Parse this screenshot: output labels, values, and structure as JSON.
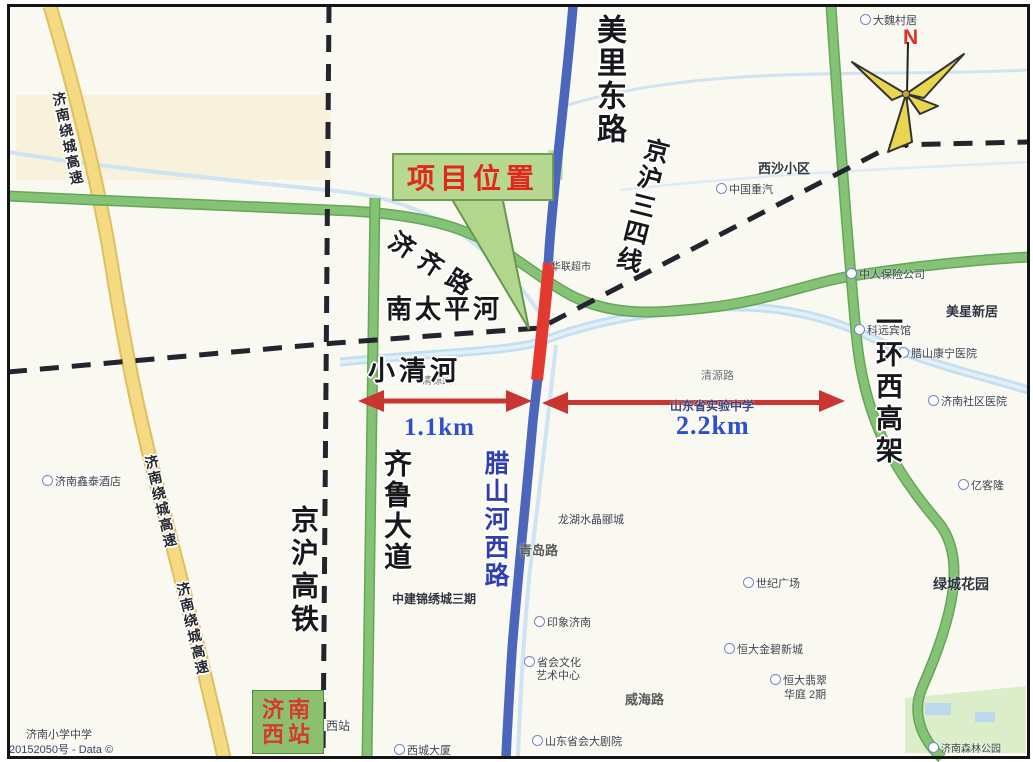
{
  "frame": {
    "watermark": "20152050号 - Data ©"
  },
  "compass": {
    "north_label": "N"
  },
  "callout": {
    "project_label": "项目位置"
  },
  "distances": {
    "left": "1.1km",
    "right": "2.2km"
  },
  "station": {
    "line1": "济南",
    "line2": "西站"
  },
  "road_labels": {
    "meili_east_road": "美里东路",
    "jinghu_line34": "京沪三四线",
    "jiqi_road": "济齐路",
    "south_taiping_river": "南太平河",
    "xiaoqing_river": "小清河",
    "qilu_avenue": "齐鲁大道",
    "jinghu_hsr": "京沪高铁",
    "lashan_river_west_road": "腊山河西路",
    "west_ring_viaduct": "一环西高架",
    "raocheng_expressway_1": "济南绕城高速",
    "raocheng_expressway_2": "济南绕城高速",
    "raocheng_expressway_3": "济南绕城高速"
  },
  "minor_labels": [
    {
      "id": "xisha",
      "text": "西沙小区"
    },
    {
      "id": "zhongqi",
      "text": "中国重汽"
    },
    {
      "id": "daweicun",
      "text": "大魏村居"
    },
    {
      "id": "meixing",
      "text": "美星新居"
    },
    {
      "id": "keyuan",
      "text": "科远宾馆"
    },
    {
      "id": "lashan-hospital",
      "text": "腊山康宁医院"
    },
    {
      "id": "shequ-hospital",
      "text": "济南社区医院"
    },
    {
      "id": "zhongren",
      "text": "中人保险公司"
    },
    {
      "id": "yikelong",
      "text": "亿客隆"
    },
    {
      "id": "lvcheng",
      "text": "绿城花园"
    },
    {
      "id": "hengda-feicui",
      "text": "恒大翡翠"
    },
    {
      "id": "hengda-feicui-2",
      "text": "华庭 2期"
    },
    {
      "id": "weihai-road",
      "text": "威海路"
    },
    {
      "id": "theater",
      "text": "山东省会大剧院"
    },
    {
      "id": "culture-1",
      "text": "省会文化"
    },
    {
      "id": "culture-2",
      "text": "艺术中心"
    },
    {
      "id": "yinxiang",
      "text": "印象济南"
    },
    {
      "id": "qingdao-road",
      "text": "青岛路"
    },
    {
      "id": "longhu",
      "text": "龙湖水晶郦城"
    },
    {
      "id": "zhongjian",
      "text": "中建锦绣城三期"
    },
    {
      "id": "xizhan",
      "text": "西站"
    },
    {
      "id": "xicheng-tower",
      "text": "西城大厦"
    },
    {
      "id": "shiyan-school",
      "text": "山东省实验中学"
    },
    {
      "id": "qingyuan-west",
      "text": "清源路"
    },
    {
      "id": "qingyuan-east",
      "text": "清源路"
    },
    {
      "id": "hualian",
      "text": "华联超市"
    },
    {
      "id": "forest-park",
      "text": "济南森林公园"
    },
    {
      "id": "xintai-hotel",
      "text": "济南鑫泰酒店"
    },
    {
      "id": "school",
      "text": "济南小学中学"
    },
    {
      "id": "jinbi",
      "text": "恒大金碧新城"
    },
    {
      "id": "shiji",
      "text": "世纪广场"
    }
  ],
  "colors": {
    "highway_yellow": "#f3da83",
    "road_green": "#84c276",
    "road_blue": "#4b66ba",
    "river_blue": "#c5dff2",
    "highlight_red": "#e23a31",
    "rail_black": "#24242e",
    "callout_green": "#b6d890",
    "callout_text_red": "#e2271c",
    "distance_blue": "#2b4fd0",
    "station_green": "#8cc06c",
    "station_text_red": "#d43a2f",
    "compass_yellow": "#e9d64e",
    "north_red": "#e03127"
  }
}
